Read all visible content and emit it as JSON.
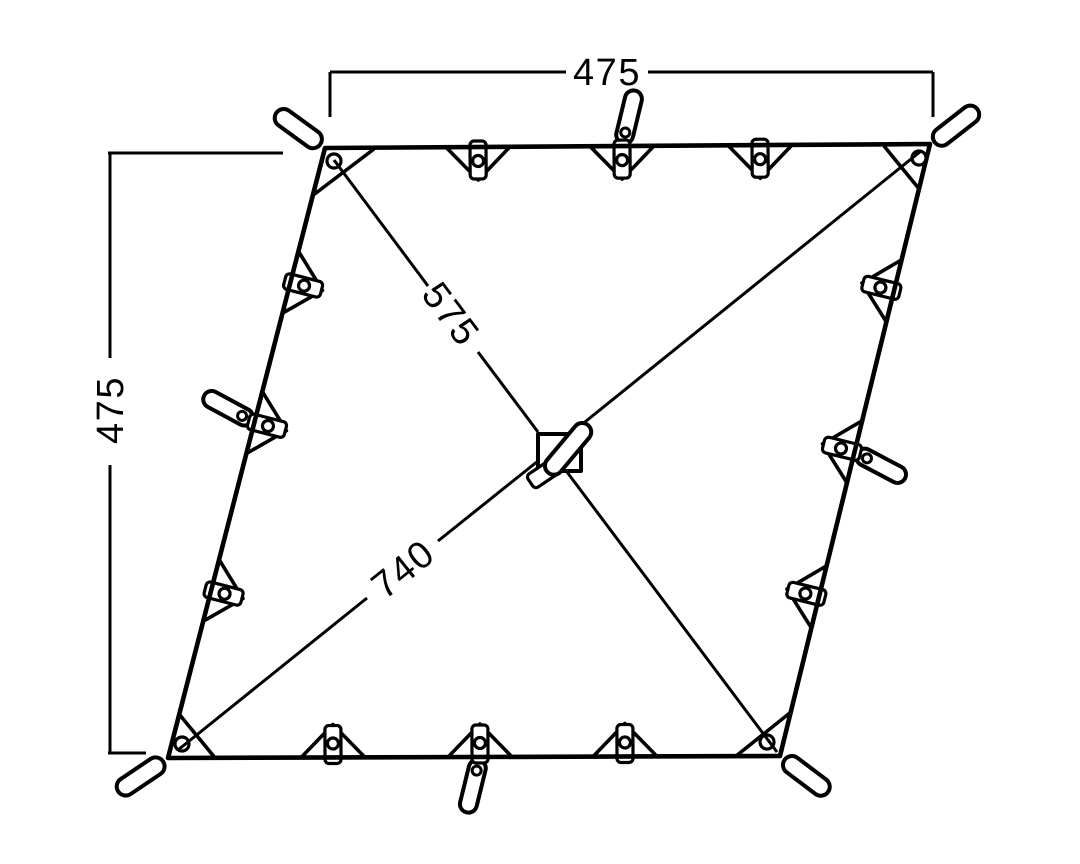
{
  "canvas": {
    "background": "#ffffff",
    "ink_color": "#000000"
  },
  "dimension_labels": {
    "top_width": "475",
    "left_height": "475",
    "upper_diagonal": "575",
    "lower_diagonal": "740"
  },
  "figure": {
    "kind": "tarp top-view dimension drawing",
    "corner_guy_loops": 4,
    "edge_attachment_tabs": 12,
    "mid_edge_loops": 4,
    "center_feature": "square reinforcement patch with webbing loop"
  }
}
